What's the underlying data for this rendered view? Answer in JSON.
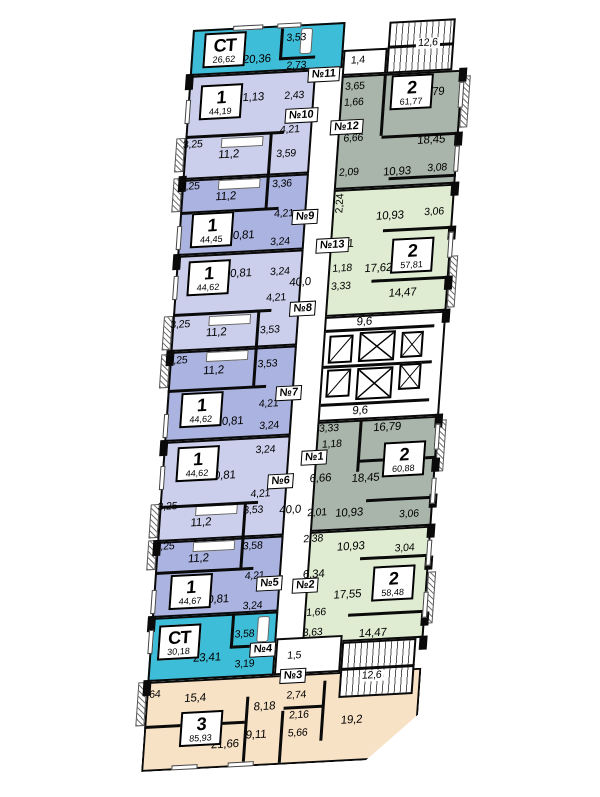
{
  "plan": {
    "corridor_area": "40,0",
    "lift_hall_top": "9,6",
    "lift_hall_bottom": "9,6",
    "stairs_top": "12,6",
    "stairs_bottom": "12,6",
    "vestibule_top": "1,4",
    "vestibule_bottom": "1,5"
  },
  "colors": {
    "studio": "#3ebdd8",
    "one_room_light": "#cbcfeb",
    "one_room_dark": "#abb3e0",
    "two_room_gray": "#a9b5ab",
    "two_room_green": "#dfecd2",
    "three_room_peach": "#f8e2c6"
  },
  "apartments": [
    {
      "unit": "№11",
      "type": "СТ",
      "area": "26,62",
      "rooms": {
        "living": "20,36",
        "bath": "3,53",
        "hall": "2,73"
      }
    },
    {
      "unit": "№10",
      "type": "1",
      "area": "44,19",
      "rooms": {
        "living": "21,13",
        "closet": "2,43",
        "hall": "4,21",
        "balcony": "3,25",
        "kitchen": "11,2",
        "bath": "3,59"
      }
    },
    {
      "unit": "№9",
      "type": "1",
      "area": "44,45",
      "rooms": {
        "balcony": "3,25",
        "kitchen": "11,2",
        "bath": "3,36",
        "hall": "4,21",
        "living": "20,81",
        "wc": "3,24"
      }
    },
    {
      "unit": "№8",
      "type": "1",
      "area": "44,62",
      "rooms": {
        "living": "20,81",
        "wc": "3,24",
        "hall": "4,21",
        "balcony": "3,25",
        "kitchen": "11,2",
        "bath": "3,53"
      }
    },
    {
      "unit": "№7",
      "type": "1",
      "area": "44,62",
      "rooms": {
        "balcony": "3,25",
        "kitchen": "11,2",
        "bath": "3,53",
        "hall": "4,21",
        "living": "20,81",
        "wc": "3,24"
      }
    },
    {
      "unit": "№6",
      "type": "1",
      "area": "44,62",
      "rooms": {
        "wc": "3,24",
        "living": "20,81",
        "hall": "4,21",
        "balcony": "3,25",
        "kitchen": "11,2",
        "bath": "3,53"
      }
    },
    {
      "unit": "№5",
      "type": "1",
      "area": "44,67",
      "rooms": {
        "balcony": "3,25",
        "kitchen": "11,2",
        "bath": "3,58",
        "hall": "4,21",
        "living": "20,81",
        "wc": "3,24"
      }
    },
    {
      "unit": "№4",
      "type": "СТ",
      "area": "30,18",
      "rooms": {
        "living": "23,41",
        "bath": "3,58",
        "hall": "3,19"
      }
    },
    {
      "unit": "№3",
      "type": "3",
      "area": "85,93",
      "rooms": {
        "balcony": ",64",
        "room1": "15,4",
        "hall": "8,18",
        "closet": "2,74",
        "wc": "2,16",
        "corridor": "9,11",
        "bath": "5,66",
        "room2": "21,66",
        "room3": "19,2"
      }
    },
    {
      "unit": "№12",
      "type": "2",
      "area": "61,77",
      "rooms": {
        "bath": "3,65",
        "wc": "1,66",
        "room1": "16,79",
        "hall": "6,66",
        "room2": "18,45",
        "entry": "2,09",
        "kitchen": "10,93",
        "dim": "3,08"
      }
    },
    {
      "unit": "№13",
      "type": "2",
      "area": "57,81",
      "rooms": {
        "entry": "2,24",
        "kitchen": "10,93",
        "dim": "3,06",
        "hall": "6,51",
        "room1": "17,62",
        "wc": "1,18",
        "bath": "3,33",
        "room2": "14,47"
      }
    },
    {
      "unit": "№1",
      "type": "2",
      "area": "60,88",
      "rooms": {
        "bath": "3,33",
        "room1": "16,79",
        "wc": "1,18",
        "hall": "6,66",
        "room2": "18,45",
        "entry": "2,01",
        "kitchen": "10,93",
        "dim": "3,06"
      }
    },
    {
      "unit": "№2",
      "type": "2",
      "area": "58,48",
      "rooms": {
        "entry": "2,38",
        "kitchen": "10,93",
        "dim": "3,04",
        "hall": "6,34",
        "room1": "17,55",
        "wc": "1,66",
        "bath": "3,63",
        "room2": "14,47"
      }
    }
  ]
}
